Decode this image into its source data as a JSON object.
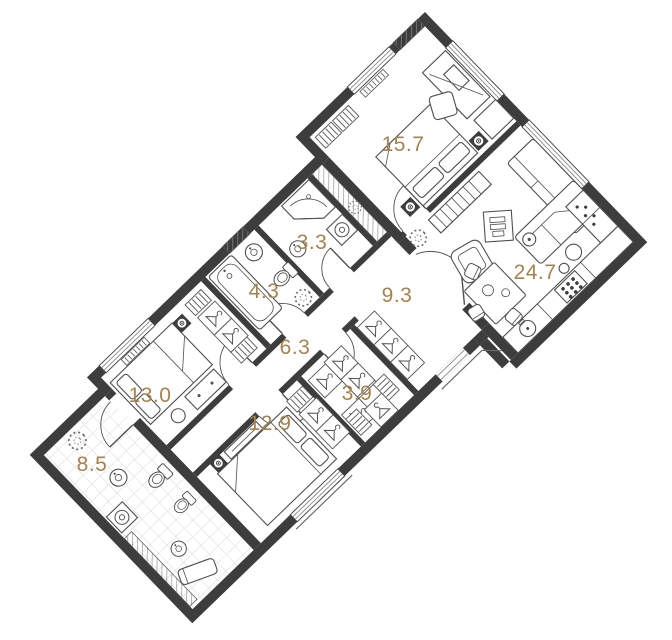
{
  "plan": {
    "type": "apartment-floor-plan",
    "wall_color": "#3d3d3d",
    "accent_color": "#a5834e",
    "furniture_line_color": "#4f4f4f",
    "background": "#ffffff",
    "rotation_deg": -44,
    "rooms": [
      {
        "id": "room-15-7",
        "area": "15.7"
      },
      {
        "id": "room-24-7",
        "area": "24.7"
      },
      {
        "id": "room-3-3",
        "area": "3.3"
      },
      {
        "id": "room-4-3",
        "area": "4.3"
      },
      {
        "id": "room-9-3",
        "area": "9.3"
      },
      {
        "id": "room-6-3",
        "area": "6.3"
      },
      {
        "id": "room-3-9",
        "area": "3.9"
      },
      {
        "id": "room-13-0",
        "area": "13.0"
      },
      {
        "id": "room-12-9",
        "area": "12.9"
      },
      {
        "id": "room-8-5",
        "area": "8.5"
      }
    ]
  }
}
